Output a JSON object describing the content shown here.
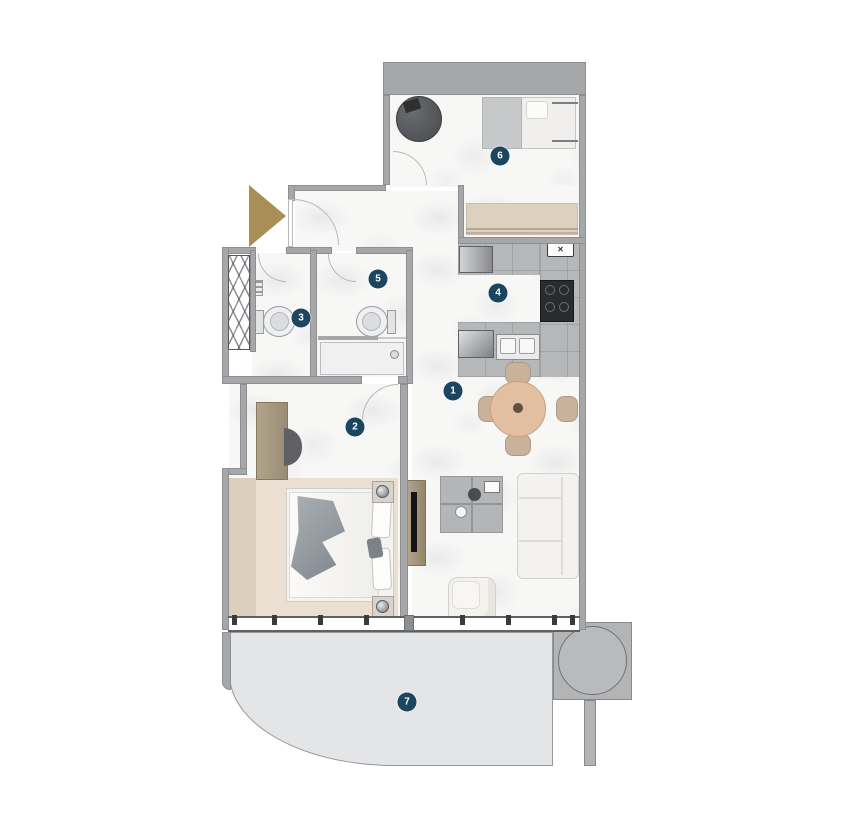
{
  "plan": {
    "markers": [
      {
        "label": "1"
      },
      {
        "label": "2"
      },
      {
        "label": "3"
      },
      {
        "label": "4"
      },
      {
        "label": "5"
      },
      {
        "label": "6"
      },
      {
        "label": "7"
      }
    ],
    "vent_glyph": "✕"
  },
  "colors": {
    "wall": "#a6a7a9",
    "wall-edge": "#8e8f92",
    "floor": "#f7f7f6",
    "tile": "#b6b7b9",
    "marker": "#1c4560",
    "arrow": "#a98e55",
    "balcony": "#e4e5e7",
    "balcony-edge": "#96979a",
    "rug": "#eadfd0",
    "ledge": "#ddcfbe",
    "wood": "#a89a82",
    "bench": "#ddd0bf",
    "sofa": "#f3f2ee",
    "table-tan": "#e3bfa2",
    "chair-tan": "#c8b29b",
    "appliance-dark": "#2a2b2d",
    "throw-gray": "#99a0a6"
  }
}
